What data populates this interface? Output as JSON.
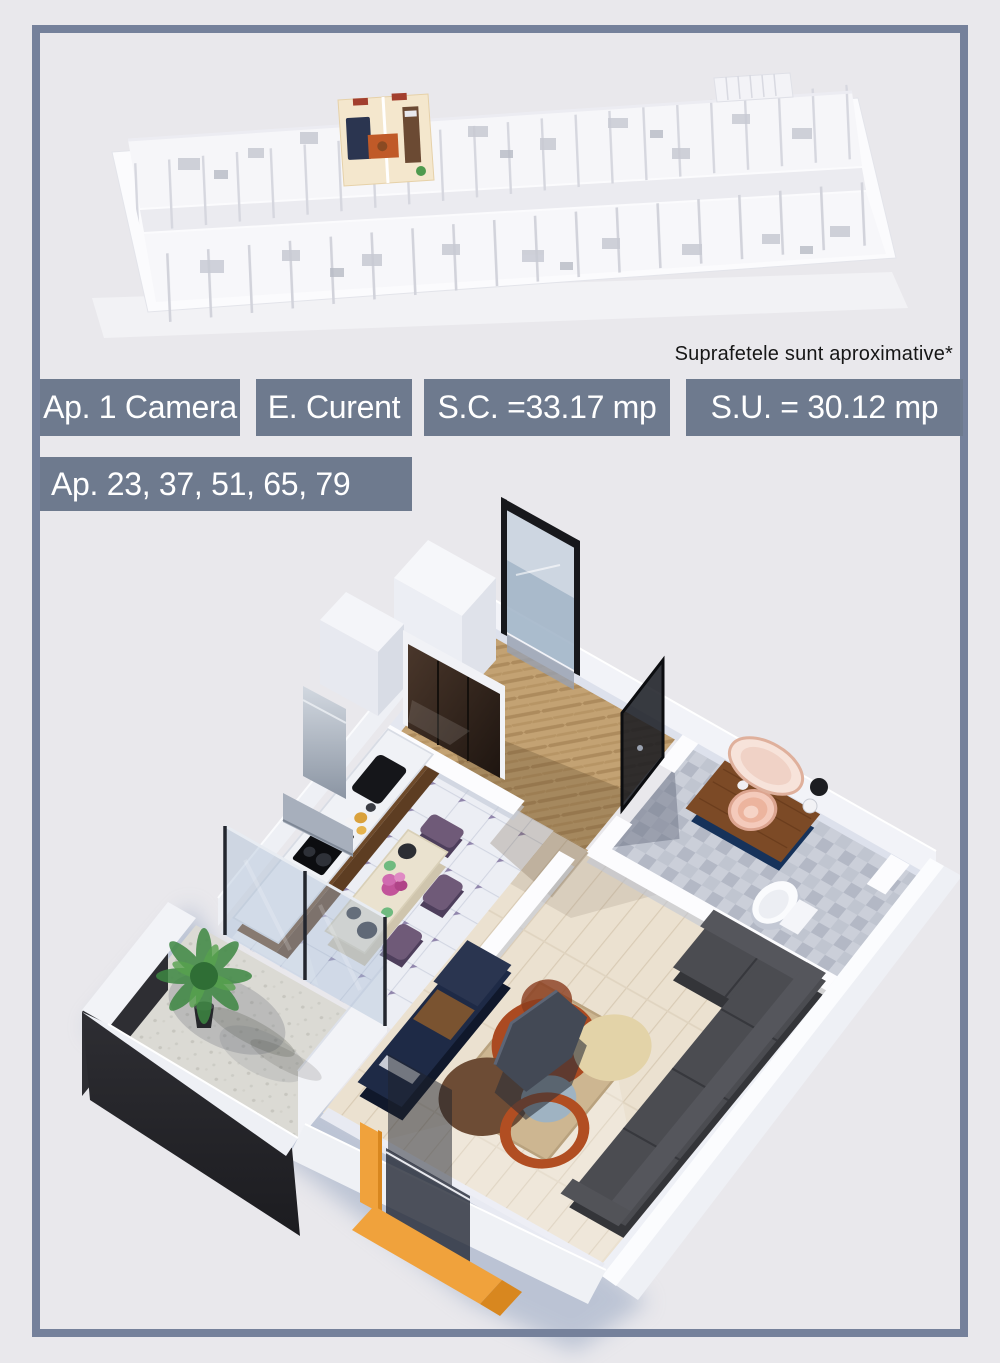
{
  "page": {
    "background": "#e9e8ec",
    "frame_border": "#75819b"
  },
  "note": {
    "text": "Suprafetele sunt aproximative*",
    "color": "#161616"
  },
  "badges": {
    "background": "#6e7a8e",
    "text_color": "#ffffff",
    "apartment_type": "Ap. 1 Camera",
    "construction_stage": "E. Curent",
    "built_surface": "S.C. =33.17 mp",
    "usable_surface": "S.U. = 30.12 mp",
    "apartment_numbers": "Ap. 23, 37, 51, 65, 79"
  },
  "scene_colors": {
    "accent_orange": "#f0a23c",
    "sofa_charcoal": "#4b4c51",
    "furniture_navy": "#1e2a46",
    "vanity_navy": "#1c3a63",
    "rug_rust": "#ab4a21",
    "rug_brown": "#6d4c35",
    "hall_parquet_tan": "#c3a273",
    "living_wood_floor": "#ebe1d0",
    "balcony_parapet_black": "#232327",
    "plant_green": "#3d8742"
  }
}
